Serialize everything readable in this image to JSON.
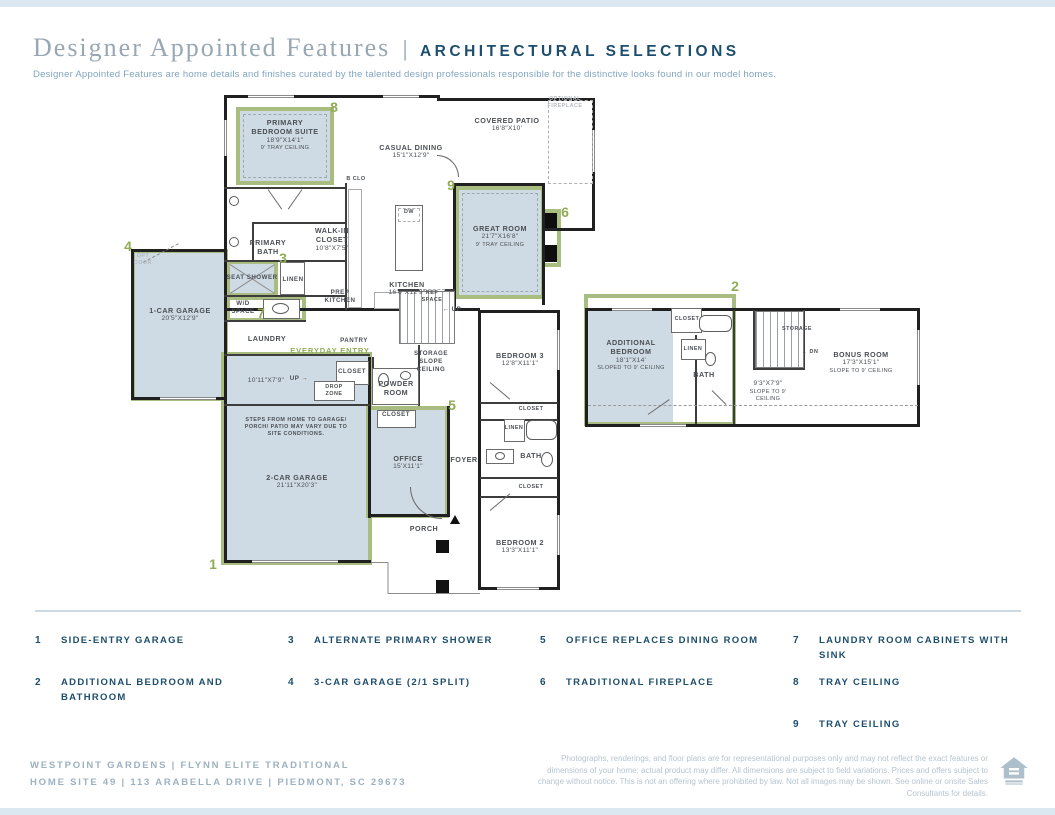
{
  "palette": {
    "navy": "#1d4e6d",
    "sage": "#8fac55",
    "sage_border": "#a9bd80",
    "fill_blue": "#cfdbe4",
    "ink": "#4a4f54",
    "serif_gray": "#97a7b4",
    "subtitle_blue": "#82a6c2",
    "footer_gray": "#9db1c1",
    "disclaimer_gray": "#b5c5d1",
    "band_blue": "#dbe8f2",
    "divider": "#ccd9e2"
  },
  "header": {
    "title_serif": "Designer Appointed Features",
    "divider": "|",
    "title_caps": "ARCHITECTURAL SELECTIONS",
    "subtitle": "Designer Appointed Features are home details and finishes curated by the talented design professionals responsible for the distinctive looks found in our model homes."
  },
  "plan": {
    "rooms": [
      {
        "id": "primary-bedroom-suite",
        "name": "PRIMARY BEDROOM SUITE",
        "dims": "18'9\"X14'1\"",
        "note": "9' TRAY CEILING",
        "x": 285,
        "y": 118,
        "w": 76
      },
      {
        "id": "casual-dining",
        "name": "CASUAL DINING",
        "dims": "15'1\"X12'9\"",
        "x": 411,
        "y": 143,
        "w": 70
      },
      {
        "id": "covered-patio",
        "name": "COVERED PATIO",
        "dims": "16'8\"X10'",
        "x": 507,
        "y": 116,
        "w": 70
      },
      {
        "id": "optional-fireplace",
        "name": "OPTIONAL FIREPLACE",
        "x": 565,
        "y": 96,
        "w": 52,
        "cls": "gray micro"
      },
      {
        "id": "great-room",
        "name": "GREAT ROOM",
        "dims": "21'7\"X16'8\"",
        "note": "9' TRAY CEILING",
        "x": 500,
        "y": 224,
        "w": 70
      },
      {
        "id": "walk-in-closet",
        "name": "WALK-IN CLOSET",
        "dims": "10'8\"X7'5\"",
        "x": 332,
        "y": 226,
        "w": 58
      },
      {
        "id": "primary-bath",
        "name": "PRIMARY BATH",
        "x": 268,
        "y": 238,
        "w": 56
      },
      {
        "id": "bedroom-closet",
        "name": "B CLO",
        "x": 356,
        "y": 176,
        "w": 24,
        "cls": "micro"
      },
      {
        "id": "kitchen",
        "name": "KITCHEN",
        "dims": "16'6\"X12'9\"",
        "x": 407,
        "y": 280,
        "w": 70
      },
      {
        "id": "prep-kitchen",
        "name": "PREP KITCHEN",
        "x": 340,
        "y": 289,
        "w": 44,
        "cls": "tiny"
      },
      {
        "id": "seat-shower",
        "name": "SEAT SHOWER",
        "x": 252,
        "y": 274,
        "w": 56,
        "cls": "tiny"
      },
      {
        "id": "linen-primary",
        "name": "LINEN",
        "x": 293,
        "y": 276,
        "w": 30,
        "cls": "tiny"
      },
      {
        "id": "wd-space",
        "name": "W/D SPACE",
        "x": 243,
        "y": 300,
        "w": 36,
        "cls": "tiny"
      },
      {
        "id": "laundry",
        "name": "LAUNDRY",
        "x": 267,
        "y": 334,
        "w": 64
      },
      {
        "id": "pantry",
        "name": "PANTRY",
        "x": 354,
        "y": 337,
        "w": 44,
        "cls": "tiny"
      },
      {
        "id": "everyday-entry",
        "name": "EVERYDAY ENTRY",
        "x": 330,
        "y": 346,
        "w": 84,
        "cls": "green"
      },
      {
        "id": "storage-slope-ceiling",
        "name": "STORAGE SLOPE CEILING",
        "x": 431,
        "y": 350,
        "w": 48,
        "cls": "tiny"
      },
      {
        "id": "ref-space",
        "name": "REF SPACE",
        "x": 432,
        "y": 290,
        "w": 26,
        "cls": "micro"
      },
      {
        "id": "stairs-up",
        "name": "← UP",
        "x": 452,
        "y": 306,
        "w": 30,
        "cls": "tiny"
      },
      {
        "id": "one-car-garage",
        "name": "1-CAR GARAGE",
        "dims": "20'5\"X12'9\"",
        "x": 180,
        "y": 306,
        "w": 70
      },
      {
        "id": "opt-door",
        "name": "OPT DOOR",
        "x": 143,
        "y": 253,
        "w": 28,
        "cls": "gray micro"
      },
      {
        "id": "flex-space",
        "dims": "10'11\"X7'9\"",
        "x": 266,
        "y": 377,
        "w": 64
      },
      {
        "id": "stairs-up-flex",
        "name": "UP →",
        "x": 299,
        "y": 375,
        "w": 28,
        "cls": "tiny"
      },
      {
        "id": "closet-everyday",
        "name": "CLOSET",
        "x": 352,
        "y": 368,
        "w": 34,
        "cls": "tiny"
      },
      {
        "id": "drop-zone",
        "name": "DROP ZONE",
        "x": 334,
        "y": 384,
        "w": 36,
        "cls": "micro"
      },
      {
        "id": "powder-room",
        "name": "POWDER ROOM",
        "x": 396,
        "y": 379,
        "w": 56
      },
      {
        "id": "closet-office",
        "name": "CLOSET",
        "x": 396,
        "y": 411,
        "w": 34,
        "cls": "tiny"
      },
      {
        "id": "office",
        "name": "OFFICE",
        "dims": "15'X11'1\"",
        "x": 408,
        "y": 454,
        "w": 54
      },
      {
        "id": "foyer",
        "name": "FOYER",
        "x": 464,
        "y": 455,
        "w": 40
      },
      {
        "id": "two-car-garage",
        "name": "2-CAR GARAGE",
        "dims": "21'11\"X20'3\"",
        "x": 297,
        "y": 473,
        "w": 76
      },
      {
        "id": "steps-note",
        "name": "STEPS FROM HOME TO GARAGE/ PORCH/ PATIO MAY VARY DUE TO SITE CONDITIONS.",
        "x": 296,
        "y": 417,
        "w": 118,
        "cls": "micro"
      },
      {
        "id": "porch",
        "name": "PORCH",
        "x": 424,
        "y": 524,
        "w": 44
      },
      {
        "id": "bedroom-3",
        "name": "BEDROOM 3",
        "dims": "12'8\"X11'1\"",
        "x": 520,
        "y": 351,
        "w": 70
      },
      {
        "id": "closet-bedroom3",
        "name": "CLOSET",
        "x": 531,
        "y": 406,
        "w": 34,
        "cls": "micro"
      },
      {
        "id": "linen-hall",
        "name": "LINEN",
        "x": 514,
        "y": 425,
        "w": 26,
        "cls": "micro"
      },
      {
        "id": "hall-bath",
        "name": "BATH",
        "x": 531,
        "y": 451,
        "w": 36
      },
      {
        "id": "closet-bedroom2",
        "name": "CLOSET",
        "x": 531,
        "y": 484,
        "w": 34,
        "cls": "micro"
      },
      {
        "id": "bedroom-2",
        "name": "BEDROOM 2",
        "dims": "13'3\"X11'1\"",
        "x": 520,
        "y": 538,
        "w": 70
      },
      {
        "id": "additional-bedroom",
        "name": "ADDITIONAL BEDROOM",
        "dims": "18'1\"X14'",
        "note": "SLOPED TO 9' CEILING",
        "x": 631,
        "y": 338,
        "w": 76
      },
      {
        "id": "closet-additional",
        "name": "CLOSET",
        "x": 687,
        "y": 316,
        "w": 34,
        "cls": "micro"
      },
      {
        "id": "linen-additional",
        "name": "LINEN",
        "x": 693,
        "y": 346,
        "w": 26,
        "cls": "micro"
      },
      {
        "id": "bath-additional",
        "name": "BATH",
        "x": 704,
        "y": 370,
        "w": 36
      },
      {
        "id": "storage-additional",
        "name": "STORAGE",
        "x": 797,
        "y": 326,
        "w": 40,
        "cls": "micro"
      },
      {
        "id": "stairs-dn",
        "name": "← DN",
        "x": 810,
        "y": 349,
        "w": 30,
        "cls": "micro"
      },
      {
        "id": "upper-landing",
        "dims": "9'3\"X7'9\"",
        "note": "SLOPE TO 9' CEILING",
        "x": 768,
        "y": 380,
        "w": 56
      },
      {
        "id": "bonus-room",
        "name": "BONUS ROOM",
        "dims": "17'3\"X15'1\"",
        "note": "SLOPE TO 9' CEILING",
        "x": 861,
        "y": 350,
        "w": 70
      },
      {
        "id": "dishwasher",
        "name": "DW",
        "x": 409,
        "y": 209,
        "w": 18,
        "cls": "micro"
      }
    ],
    "callouts": [
      {
        "n": "8",
        "x": 334,
        "y": 99
      },
      {
        "n": "9",
        "x": 451,
        "y": 177
      },
      {
        "n": "6",
        "x": 565,
        "y": 204
      },
      {
        "n": "3",
        "x": 283,
        "y": 250
      },
      {
        "n": "4",
        "x": 128,
        "y": 238
      },
      {
        "n": "7",
        "x": 261,
        "y": 305
      },
      {
        "n": "5",
        "x": 452,
        "y": 397
      },
      {
        "n": "1",
        "x": 213,
        "y": 556
      },
      {
        "n": "2",
        "x": 735,
        "y": 278
      }
    ]
  },
  "legend": {
    "columns": [
      [
        {
          "num": "1",
          "label": "SIDE-ENTRY GARAGE"
        },
        {
          "num": "2",
          "label": "ADDITIONAL BEDROOM AND BATHROOM"
        }
      ],
      [
        {
          "num": "3",
          "label": "ALTERNATE PRIMARY SHOWER"
        },
        {
          "num": "4",
          "label": "3-CAR GARAGE (2/1 SPLIT)"
        }
      ],
      [
        {
          "num": "5",
          "label": "OFFICE REPLACES DINING ROOM"
        },
        {
          "num": "6",
          "label": "TRADITIONAL FIREPLACE"
        }
      ],
      [
        {
          "num": "7",
          "label": "LAUNDRY ROOM CABINETS WITH SINK"
        },
        {
          "num": "8",
          "label": "TRAY CEILING"
        },
        {
          "num": "9",
          "label": "TRAY CEILING"
        }
      ]
    ]
  },
  "footer": {
    "line1": "WESTPOINT GARDENS  |  FLYNN ELITE TRADITIONAL",
    "line2": "HOME SITE 49  |  113 ARABELLA DRIVE  |  PIEDMONT, SC 29673",
    "disclaimer": "Photographs, renderings, and floor plans are for representational purposes only and may not reflect the exact features or dimensions of your home; actual product may differ. All dimensions are subject to field variations. Prices and offers subject to change without notice. This is not an offering where prohibited by law. Not all images may be shown. See online or onsite Sales Consultants for details.",
    "logo": "equal-housing-opportunity-logo"
  }
}
